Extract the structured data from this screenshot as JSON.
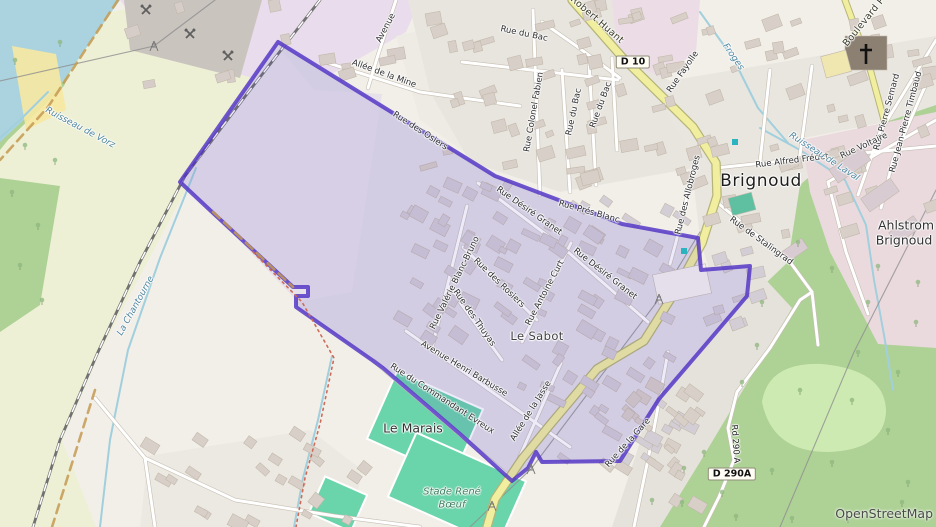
{
  "attribution": "OpenStreetMap",
  "colors": {
    "boundary": "#5132c4",
    "boundary_fill": "rgba(81,50,196,0.10)",
    "water": "#aad3df",
    "forest": "#aed196",
    "meadow": "#cdeab2",
    "farmland": "#eef0d5",
    "industrial": "#e9dcec",
    "industrial_pink": "#eadade",
    "residential": "#e3e1dc",
    "quarry": "#c9c4be",
    "pitch": "#6ad4ab",
    "road_yellow": "#f1ef9f",
    "road_yellow_casing": "#b5b578",
    "road_white": "#ffffff",
    "road_casing": "#c6beb2",
    "railway": "#717171",
    "stream": "#a1cfdd",
    "admin_dash": "#c49a52",
    "path_red": "#cf6a58",
    "building": "#d8d0c8",
    "building_tinted": "#d3cdd6"
  },
  "labels": [
    {
      "t": "Avenue",
      "x": 386,
      "y": 28,
      "r": -62,
      "c": "st"
    },
    {
      "t": "Allée de la Mine",
      "x": 384,
      "y": 74,
      "r": 20,
      "c": "st"
    },
    {
      "t": "Rue du Bac",
      "x": 524,
      "y": 34,
      "r": 12,
      "c": "st"
    },
    {
      "t": "Rue Colonel Fabien",
      "x": 534,
      "y": 112,
      "r": -80,
      "c": "st"
    },
    {
      "t": "Rue du Bac",
      "x": 574,
      "y": 112,
      "r": -78,
      "c": "st"
    },
    {
      "t": "Rue du Bac",
      "x": 601,
      "y": 105,
      "r": -70,
      "c": "st"
    },
    {
      "t": "Rue Fayolle",
      "x": 683,
      "y": 72,
      "r": -55,
      "c": "st"
    },
    {
      "t": "Robert Huant",
      "x": 597,
      "y": 20,
      "r": 41,
      "c": "stl"
    },
    {
      "t": "Boulevard P",
      "x": 864,
      "y": 22,
      "r": -51,
      "c": "stl"
    },
    {
      "t": "Rue Pierre Semard",
      "x": 887,
      "y": 112,
      "r": -75,
      "c": "st"
    },
    {
      "t": "Rue Jean-Pierre Timbaud",
      "x": 906,
      "y": 122,
      "r": -75,
      "c": "st"
    },
    {
      "t": "Rue Voltaire",
      "x": 864,
      "y": 146,
      "r": -25,
      "c": "st"
    },
    {
      "t": "Rue Alfred Frédet",
      "x": 792,
      "y": 161,
      "r": -7,
      "c": "st"
    },
    {
      "t": "Rue des Allobroges",
      "x": 688,
      "y": 195,
      "r": -76,
      "c": "st"
    },
    {
      "t": "Rue de Stalingrad",
      "x": 761,
      "y": 241,
      "r": 36,
      "c": "st"
    },
    {
      "t": "Rue Désiré Granet",
      "x": 529,
      "y": 211,
      "r": 35,
      "c": "st"
    },
    {
      "t": "Rue Désiré Granet",
      "x": 605,
      "y": 274,
      "r": 38,
      "c": "st"
    },
    {
      "t": "Rue Prés Blanc",
      "x": 589,
      "y": 212,
      "r": 16,
      "c": "st"
    },
    {
      "t": "Rue des Osiers",
      "x": 420,
      "y": 131,
      "r": 33,
      "c": "st"
    },
    {
      "t": "Rue Valérie Blanc-Bruno",
      "x": 455,
      "y": 283,
      "r": -64,
      "c": "st"
    },
    {
      "t": "Rue des Rosiers",
      "x": 499,
      "y": 283,
      "r": 44,
      "c": "st"
    },
    {
      "t": "Rue des Thuyas",
      "x": 474,
      "y": 318,
      "r": 55,
      "c": "st"
    },
    {
      "t": "Rue Antoine Curt",
      "x": 545,
      "y": 293,
      "r": -62,
      "c": "st"
    },
    {
      "t": "Avenue Henri Barbusse",
      "x": 464,
      "y": 369,
      "r": 31,
      "c": "st"
    },
    {
      "t": "Rue du Commandant Evreux",
      "x": 442,
      "y": 399,
      "r": 33,
      "c": "st"
    },
    {
      "t": "Allée de la Jasse",
      "x": 531,
      "y": 411,
      "r": -58,
      "c": "st"
    },
    {
      "t": "Rue de la Gare",
      "x": 628,
      "y": 443,
      "r": -48,
      "c": "st"
    },
    {
      "t": "Rd 290 A",
      "x": 735,
      "y": 444,
      "r": 86,
      "c": "rd"
    },
    {
      "t": "La Chantourne",
      "x": 136,
      "y": 306,
      "r": -61,
      "c": "wt"
    },
    {
      "t": "Ruisseau de Vorz",
      "x": 80,
      "y": 128,
      "r": 28,
      "c": "wt"
    },
    {
      "t": "Ruisseau de Laval",
      "x": 824,
      "y": 157,
      "r": 33,
      "c": "wt"
    },
    {
      "t": "Froges",
      "x": 733,
      "y": 57,
      "r": 55,
      "c": "wt"
    },
    {
      "t": "Brignoud",
      "x": 761,
      "y": 181,
      "r": 0,
      "c": "pl"
    },
    {
      "t": "Le Sabot",
      "x": 537,
      "y": 336,
      "r": 0,
      "c": "pls"
    },
    {
      "t": "Le Marais",
      "x": 413,
      "y": 428,
      "r": 0,
      "c": "pla"
    },
    {
      "t": "Ahlstrom",
      "x": 906,
      "y": 225,
      "r": 0,
      "c": "pla"
    },
    {
      "t": "Brignoud",
      "x": 904,
      "y": 240,
      "r": 0,
      "c": "pla"
    },
    {
      "t": "Stade René",
      "x": 452,
      "y": 492,
      "r": 0,
      "c": "sp"
    },
    {
      "t": "Bœuf",
      "x": 452,
      "y": 505,
      "r": 0,
      "c": "sp"
    }
  ],
  "shields": [
    {
      "t": "D 10",
      "x": 633,
      "y": 62
    },
    {
      "t": "D 290A",
      "x": 732,
      "y": 474
    }
  ],
  "icons": [
    {
      "n": "pickaxe-crossed-icon",
      "x": 146,
      "y": 10
    },
    {
      "n": "pickaxe-crossed-icon",
      "x": 190,
      "y": 34
    },
    {
      "n": "pickaxe-crossed-icon",
      "x": 228,
      "y": 56
    },
    {
      "n": "power-pylon-icon",
      "x": 154,
      "y": 46
    },
    {
      "n": "power-pylon-icon",
      "x": 659,
      "y": 299
    },
    {
      "n": "power-pylon-icon",
      "x": 531,
      "y": 469
    },
    {
      "n": "power-pylon-icon",
      "x": 492,
      "y": 506
    },
    {
      "n": "church-cross-icon",
      "x": 866,
      "y": 53
    },
    {
      "n": "recycling-container-icon",
      "x": 735,
      "y": 142
    },
    {
      "n": "recycling-container-icon",
      "x": 684,
      "y": 251
    }
  ]
}
